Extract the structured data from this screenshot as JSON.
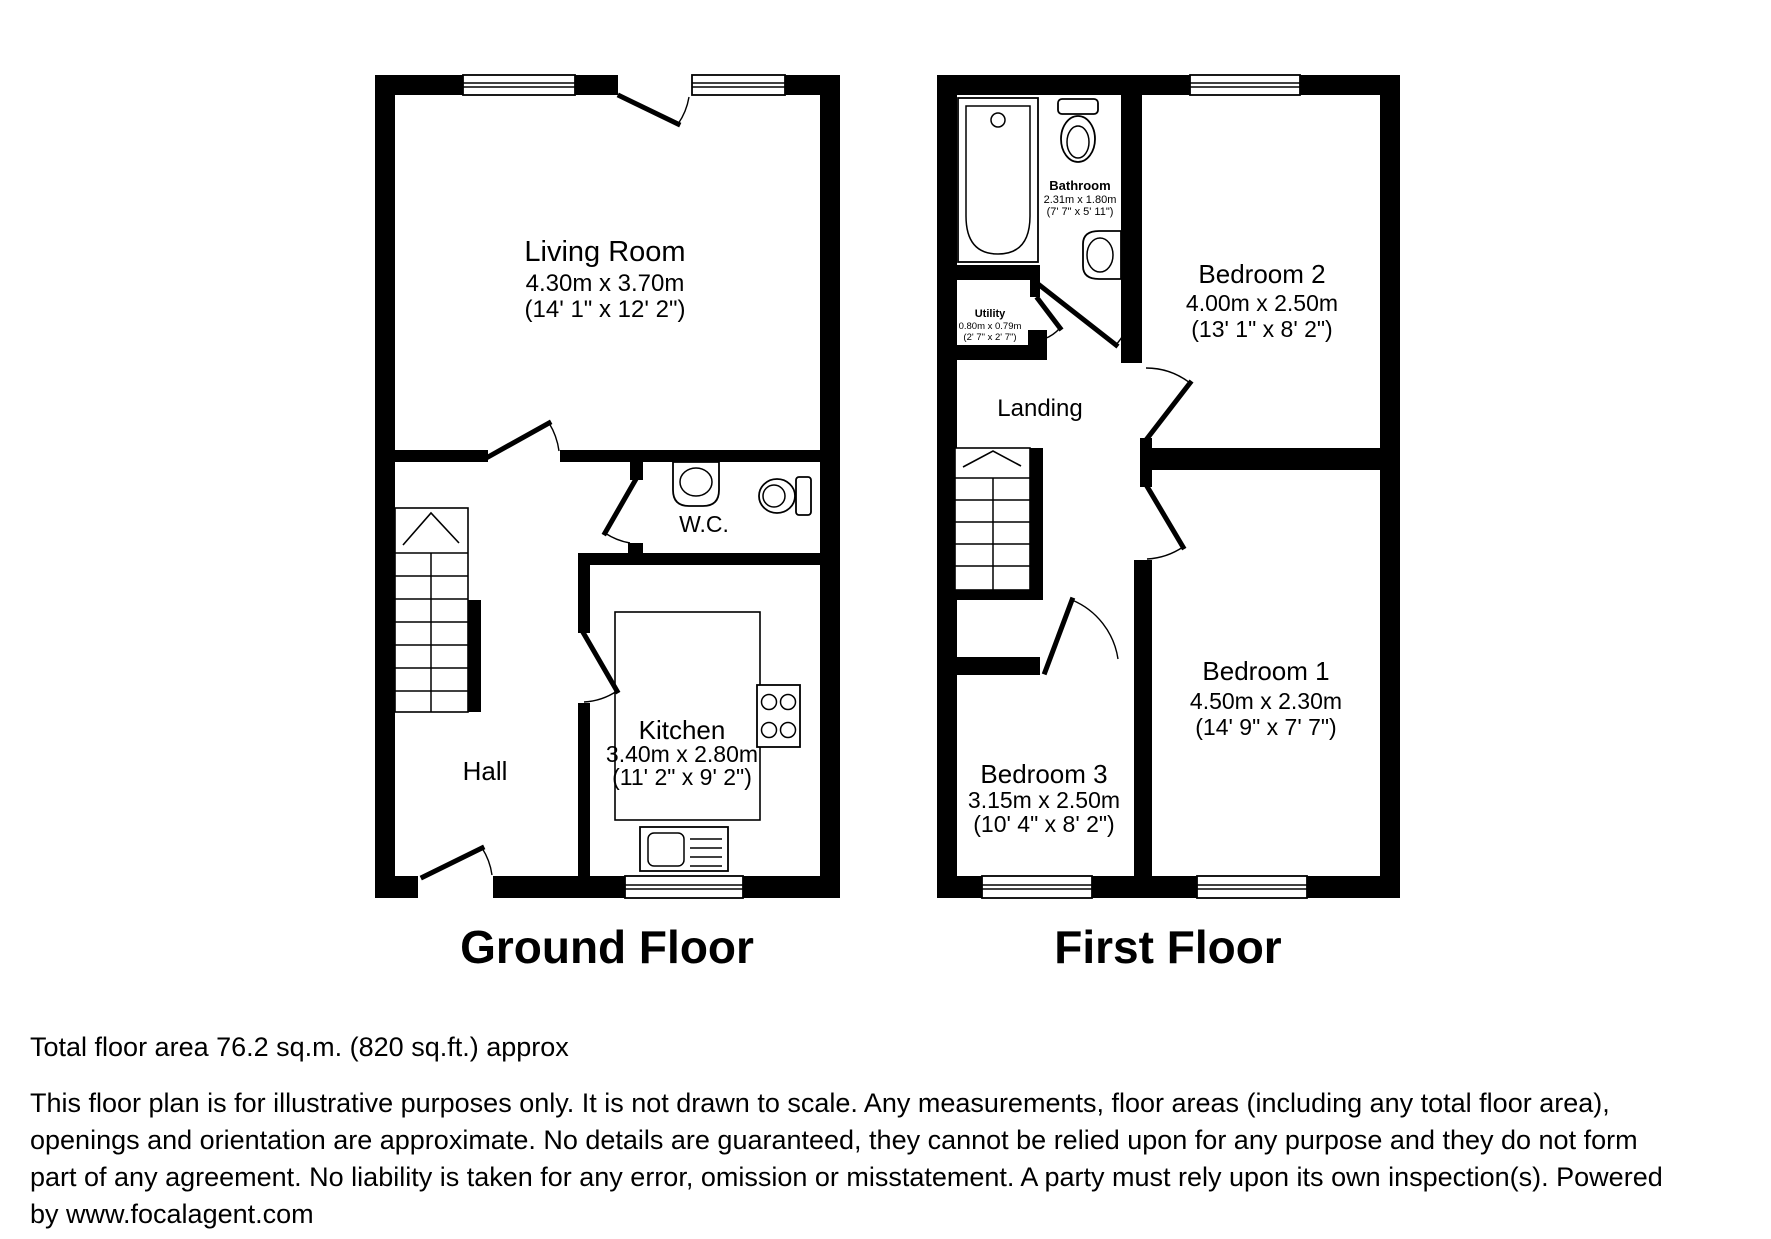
{
  "page": {
    "background_color": "#ffffff",
    "wall_color": "#000000"
  },
  "titles": {
    "ground_floor": "Ground Floor",
    "first_floor": "First Floor"
  },
  "ground_floor": {
    "rooms": {
      "living_room": {
        "name": "Living Room",
        "dim_metric": "4.30m x 3.70m",
        "dim_imperial": "(14' 1\" x 12' 2\")"
      },
      "wc": {
        "name": "W.C."
      },
      "kitchen": {
        "name": "Kitchen",
        "dim_metric": "3.40m x 2.80m",
        "dim_imperial": "(11' 2\" x 9' 2\")"
      },
      "hall": {
        "name": "Hall"
      }
    }
  },
  "first_floor": {
    "rooms": {
      "bathroom": {
        "name": "Bathroom",
        "dim_metric": "2.31m x 1.80m",
        "dim_imperial": "(7' 7\" x 5' 11\")"
      },
      "utility": {
        "name": "Utility",
        "dim_metric": "0.80m x 0.79m",
        "dim_imperial": "(2' 7\" x 2' 7\")"
      },
      "landing": {
        "name": "Landing"
      },
      "bedroom1": {
        "name": "Bedroom 1",
        "dim_metric": "4.50m x 2.30m",
        "dim_imperial": "(14' 9\" x 7' 7\")"
      },
      "bedroom2": {
        "name": "Bedroom 2",
        "dim_metric": "4.00m x 2.50m",
        "dim_imperial": "(13' 1\" x 8' 2\")"
      },
      "bedroom3": {
        "name": "Bedroom 3",
        "dim_metric": "3.15m x 2.50m",
        "dim_imperial": "(10' 4\" x 8' 2\")"
      }
    }
  },
  "footer": {
    "total_area": "Total floor area 76.2 sq.m. (820 sq.ft.) approx",
    "disclaimer_lines": [
      "This floor plan is for illustrative purposes only. It is not drawn to scale. Any measurements, floor areas (including any total floor area),",
      "openings and orientation are approximate. No details are guaranteed, they cannot be relied upon for any purpose and they do not form",
      "part of any agreement. No liability is taken for any error, omission or misstatement. A party must rely upon its own inspection(s). Powered",
      "by www.focalagent.com"
    ]
  }
}
